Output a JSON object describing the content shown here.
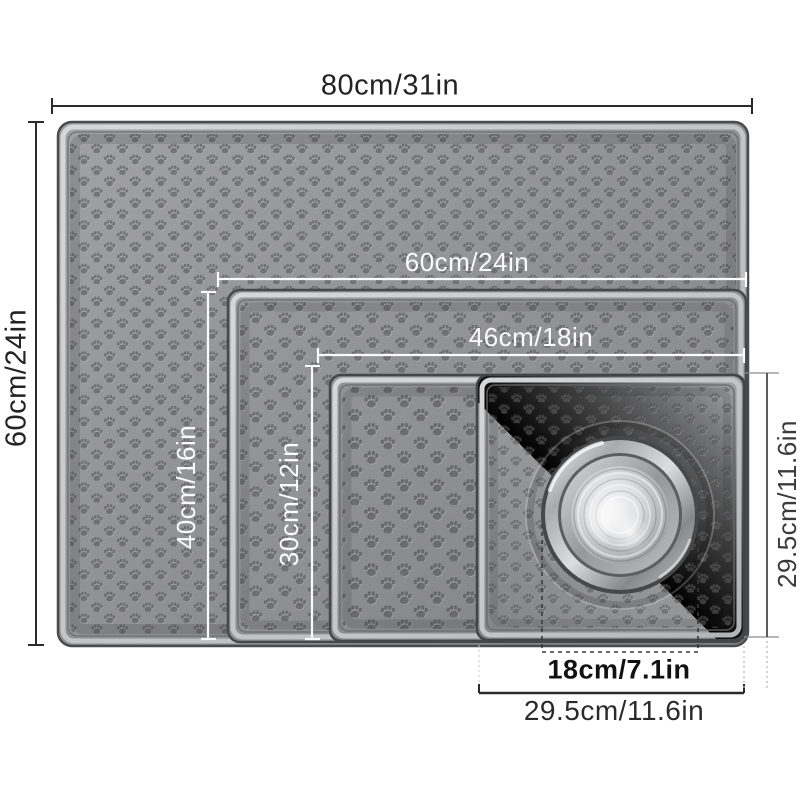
{
  "diagram": {
    "mats": [
      {
        "width_label": "80cm/31in",
        "height_label": "60cm/24in"
      },
      {
        "width_label": "60cm/24in",
        "height_label": "40cm/16in"
      },
      {
        "width_label": "46cm/18in",
        "height_label": "30cm/12in"
      },
      {
        "width_label": "29.5cm/11.6in",
        "height_label": "29.5cm/11.6in"
      }
    ],
    "bowl": {
      "diameter_label": "18cm/7.1in"
    },
    "icons": {
      "texture": "paw-print-pattern",
      "object": "stainless-steel-bowl-icon"
    },
    "colors": {
      "background": "#ffffff",
      "mat_gray": "#8f9092",
      "rim_light": "#cfd0d2",
      "dimension_dark": "#2b2b2d",
      "dimension_white": "#fafafa"
    }
  }
}
